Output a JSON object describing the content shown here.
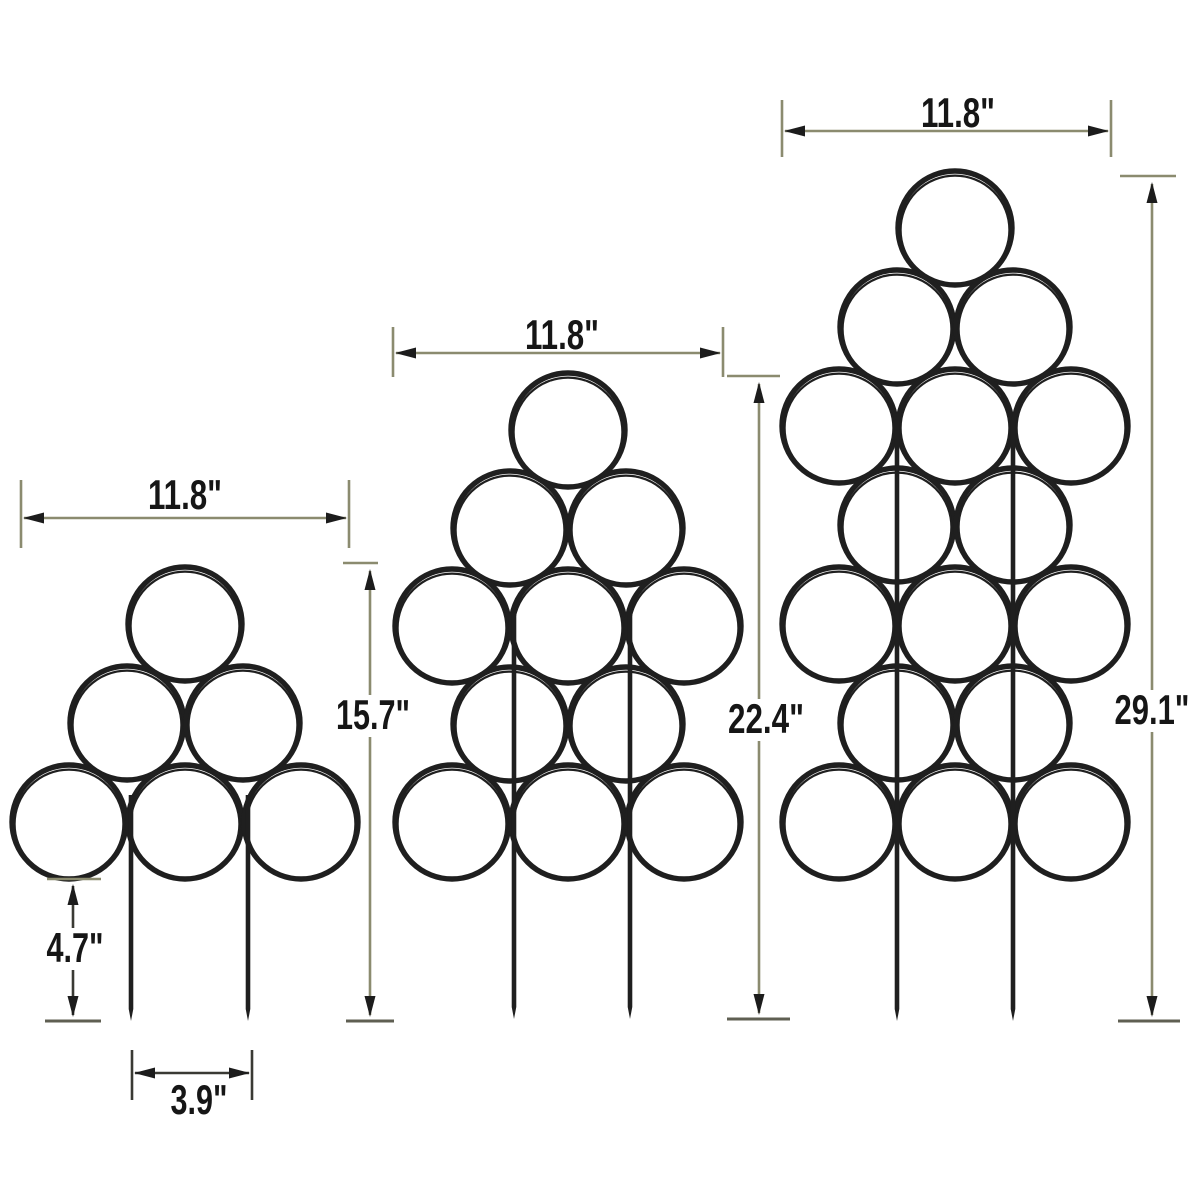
{
  "page": {
    "background": "#ffffff"
  },
  "style": {
    "wire_color": "#1f1f1f",
    "dim_color": "#8b8b6f",
    "dark_dim_color": "#3a3a34",
    "ground_tick_color": "#5f5f52",
    "arrow_color": "#1c1c1c",
    "label_color": "#161616",
    "label_font_size": 42
  },
  "canvas": {
    "width": 1200,
    "height": 1200
  },
  "trellises": [
    {
      "id": "small-trellis",
      "ring_radius": 57,
      "ring_rows": [
        {
          "y": 624,
          "xs": [
            185
          ]
        },
        {
          "y": 723,
          "xs": [
            127,
            243
          ]
        },
        {
          "y": 822,
          "xs": [
            69,
            185,
            301
          ]
        }
      ],
      "stakes": [
        {
          "x": 131,
          "top": 795,
          "bottom": 1021
        },
        {
          "x": 248,
          "top": 795,
          "bottom": 1021
        }
      ],
      "width_dim": {
        "label": "11.8\"",
        "tick_x1": 21,
        "tick_x2": 349,
        "tick_top": 480,
        "tick_bottom": 548,
        "line_y": 518,
        "label_x": 185,
        "label_y": 509,
        "label_len": 74
      },
      "height_dim": {
        "label": "15.7\"",
        "top_tick": {
          "x1": 343,
          "x2": 378,
          "y": 563
        },
        "bottom_tick": {
          "x1": 346,
          "x2": 394,
          "y": 1021
        },
        "line_x": 370,
        "line_y1": 569,
        "line_y2": 1017,
        "label_x": 373,
        "label_y": 729,
        "label_len": 74,
        "label_bg": true
      },
      "inground_dim": {
        "label": "4.7\"",
        "top_tick": {
          "x1": 47,
          "x2": 101,
          "y": 879
        },
        "bottom_tick": {
          "x1": 45,
          "x2": 101,
          "y": 1021
        },
        "line_x": 73,
        "line_y1": 884,
        "line_y2": 1017,
        "label_x": 75,
        "label_y": 962,
        "label_len": 57,
        "label_bg": true
      },
      "stake_gap_dim": {
        "label": "3.9\"",
        "tick_x1": 132,
        "tick_x2": 252,
        "tick_top": 1050,
        "tick_bottom": 1100,
        "line_y": 1073,
        "label_x": 199,
        "label_y": 1114,
        "label_len": 57
      }
    },
    {
      "id": "medium-trellis",
      "ring_radius": 57,
      "ring_rows": [
        {
          "y": 430,
          "xs": [
            568
          ]
        },
        {
          "y": 528,
          "xs": [
            510,
            626
          ]
        },
        {
          "y": 626,
          "xs": [
            452,
            568,
            684
          ]
        },
        {
          "y": 724,
          "xs": [
            510,
            626
          ]
        },
        {
          "y": 822,
          "xs": [
            452,
            568,
            684
          ]
        }
      ],
      "stakes": [
        {
          "x": 514,
          "top": 615,
          "bottom": 1019
        },
        {
          "x": 630,
          "top": 615,
          "bottom": 1019
        }
      ],
      "width_dim": {
        "label": "11.8\"",
        "tick_x1": 393,
        "tick_x2": 723,
        "tick_top": 327,
        "tick_bottom": 377,
        "line_y": 353,
        "label_x": 562,
        "label_y": 349,
        "label_len": 74
      },
      "height_dim": {
        "label": "22.4\"",
        "top_tick": {
          "x1": 727,
          "x2": 780,
          "y": 376
        },
        "bottom_tick": {
          "x1": 727,
          "x2": 790,
          "y": 1019
        },
        "line_x": 759,
        "line_y1": 382,
        "line_y2": 1015,
        "label_x": 766,
        "label_y": 733,
        "label_len": 76,
        "label_bg": true
      }
    },
    {
      "id": "large-trellis",
      "ring_radius": 57,
      "ring_rows": [
        {
          "y": 228,
          "xs": [
            955
          ]
        },
        {
          "y": 327,
          "xs": [
            897,
            1013
          ]
        },
        {
          "y": 426,
          "xs": [
            839,
            955,
            1071
          ]
        },
        {
          "y": 525,
          "xs": [
            897,
            1013
          ]
        },
        {
          "y": 624,
          "xs": [
            839,
            955,
            1071
          ]
        },
        {
          "y": 723,
          "xs": [
            897,
            1013
          ]
        },
        {
          "y": 822,
          "xs": [
            839,
            955,
            1071
          ]
        }
      ],
      "stakes": [
        {
          "x": 897,
          "top": 420,
          "bottom": 1021
        },
        {
          "x": 1013,
          "top": 420,
          "bottom": 1021
        }
      ],
      "width_dim": {
        "label": "11.8\"",
        "tick_x1": 782,
        "tick_x2": 1111,
        "tick_top": 100,
        "tick_bottom": 157,
        "line_y": 131,
        "label_x": 958,
        "label_y": 127,
        "label_len": 74
      },
      "height_dim": {
        "label": "29.1\"",
        "top_tick": {
          "x1": 1120,
          "x2": 1176,
          "y": 176
        },
        "bottom_tick": {
          "x1": 1118,
          "x2": 1180,
          "y": 1021
        },
        "line_x": 1152,
        "line_y1": 182,
        "line_y2": 1017,
        "label_x": 1152,
        "label_y": 724,
        "label_len": 75,
        "label_bg": true
      }
    }
  ]
}
